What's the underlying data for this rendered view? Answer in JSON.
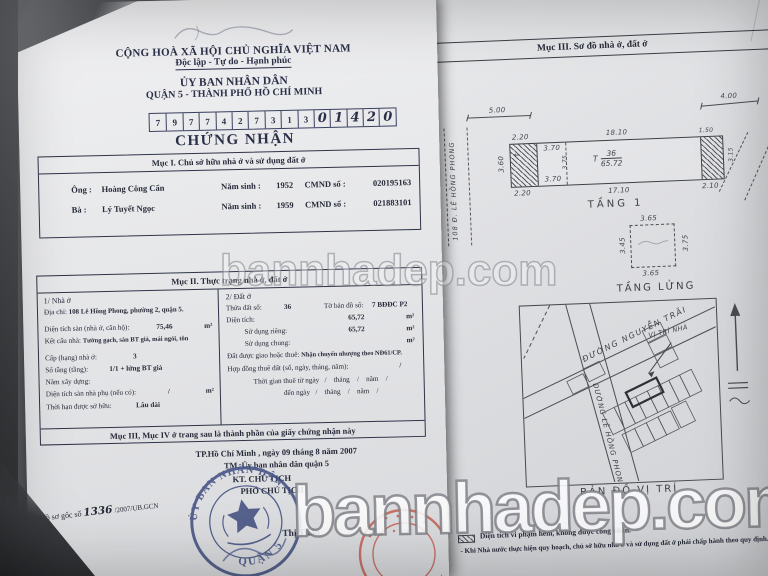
{
  "watermark": {
    "center": "bannhadep.com",
    "bottom": "bannhadep.com"
  },
  "left_page": {
    "national_header": {
      "country": "CỘNG HOÀ XÃ HỘI CHỦ NGHĨA VIỆT NAM",
      "motto": "Độc lập - Tự do - Hạnh phúc",
      "issuer": "ỦY BAN NHÂN DÂN",
      "issuer_place": "QUẬN 5 - THÀNH PHỐ HỒ CHÍ MINH"
    },
    "serial": [
      "7",
      "9",
      "7",
      "7",
      "4",
      "2",
      "7",
      "3",
      "1",
      "3",
      "0",
      "1",
      "4",
      "2",
      "0"
    ],
    "doc_title": "CHỨNG NHẬN",
    "muc1": {
      "title": "Mục I. Chủ sở hữu nhà ở và sử dụng đất ở",
      "row1": {
        "label": "Ông :",
        "name": "Hoàng Công Cẩn",
        "birth_label": "Năm sinh :",
        "birth": "1952",
        "id_label": "CMND số :",
        "id": "020195163"
      },
      "row2": {
        "label": "Bà   :",
        "name": "Lý Tuyết Ngọc",
        "birth_label": "Năm sinh :",
        "birth": "1959",
        "id_label": "CMND số :",
        "id": "021883101"
      }
    },
    "muc2": {
      "title": "Mục II. Thực trạng nhà ở, đất ở",
      "house": {
        "heading": "1/ Nhà ở",
        "address_label": "Địa chỉ:",
        "address": "108 Lê Hồng Phong, phường 2, quận 5.",
        "floor_area_label": "Diện tích sàn (nhà ở, căn hộ):",
        "floor_area": "75,46",
        "floor_area_unit": "m²",
        "structure_label": "Kết cấu nhà:",
        "structure": "Tường gạch, sàn BT giả, mái ngói, tôn",
        "grade_label": "Cấp (hạng) nhà ở:",
        "grade": "3",
        "storeys_label": "Số tầng (tầng):",
        "storeys": "1/1 + lửng BT giả",
        "year_label": "Năm xây dựng:",
        "aux_area_label": "Diện tích sàn nhà phụ (nếu có):",
        "aux_area": "/",
        "aux_area_unit": "m²",
        "tenure_label": "Thời hạn được sở hữu:",
        "tenure": "Lâu dài"
      },
      "land": {
        "heading": "2/ Đất ở",
        "parcel_label": "Thửa đất số:",
        "parcel": "36",
        "map_label": "Tờ bản đồ số:",
        "map": "7 BĐĐC P2",
        "area_label": "Diện tích:",
        "area": "65,72",
        "area_unit": "m²",
        "private_label": "Sử dụng riêng:",
        "private": "65,72",
        "private_unit": "m²",
        "shared_label": "Sử dụng chung:",
        "shared_unit": "m²",
        "origin_label": "Đất được giao hoặc thuê:",
        "origin": "Nhận chuyển nhượng theo NĐ61/CP.",
        "lease_label": "Hợp đồng thuê đất (số, ngày, tháng, năm):",
        "lease": "/",
        "lease_from": "Thời gian thuê từ ngày   /    tháng    /    năm    /",
        "lease_to": "đến ngày   /    tháng    /    năm    /"
      },
      "footer": "Mục III, Mục IV ở trang sau là thành phần của giấy chứng nhận này"
    },
    "signing": {
      "place_date": "TP.Hồ Chí Minh , ngày 09 tháng 8 năm 2007",
      "on_behalf": "TM. Ủy ban nhân dân  quận 5",
      "kt": "KT. CHỦ TỊCH",
      "deputy": "PHÓ CHỦ TỊCH",
      "stamp_top": "ỦY BAN NHÂN DÂN",
      "stamp_bottom": "QUẬN 5",
      "signer": "Thị Thảo"
    },
    "file_ref": {
      "prefix": "Hồ sơ gốc số",
      "number": "1336",
      "suffix": "/2007/UB.GCN"
    }
  },
  "right_page": {
    "title": "Mục III. Sơ đồ nhà ở, đất ở",
    "floor1": {
      "name": "TẦNG 1",
      "street": "108 Đ. LÊ HỒNG PHONG",
      "dims": {
        "left_width": "5.00",
        "right_width": "4.00",
        "top_length": "18.10",
        "bottom_length": "17.10",
        "front_top": "2.20",
        "front_bottom": "2.20",
        "front_depth": "3.60",
        "inner_top": "3.70",
        "inner_bottom": "3.70",
        "inner_depth": "3.75",
        "rear_top": "1.50",
        "rear_bottom": "2.10",
        "rear_depth": "3.15"
      },
      "parcel_tag": {
        "prefix": "T",
        "numerator": "36",
        "denominator": "65.72"
      }
    },
    "mezzanine": {
      "name": "TẦNG LỬNG",
      "dims": {
        "top": "3.65",
        "bottom": "3.65",
        "left": "3.45",
        "right": "3.75"
      }
    },
    "site_map": {
      "name": "BẢN ĐỒ VỊ TRÍ",
      "street_1": "ĐƯỜNG NGUYỄN TRÃI",
      "street_2": "ĐƯỜNG LÊ HỒNG PHONG",
      "marker": "VỊ TRÍ NHÀ"
    },
    "notes": {
      "line1": "Diện tích vi phạm hẻm, không được công nhận.",
      "line2": "- Khi Nhà nước thực hiện quy hoạch, chủ sở hữu nhà ở và sử dụng đất ở phải chấp hành theo quy định."
    }
  }
}
